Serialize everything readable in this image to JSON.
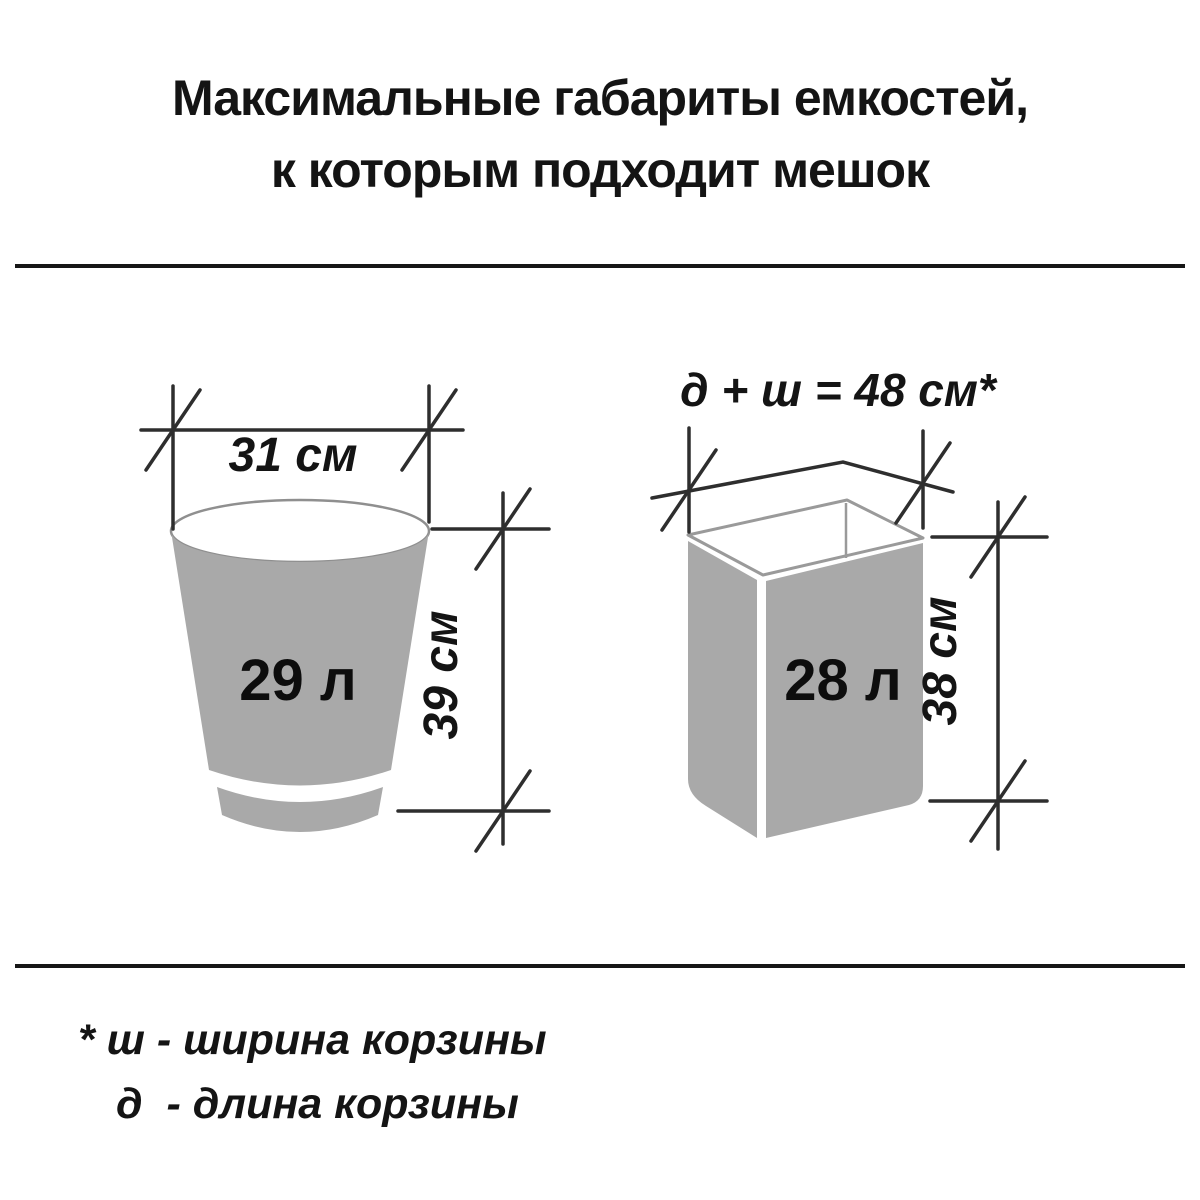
{
  "title": {
    "line1": "Максимальные габариты емкостей,",
    "line2": "к которым подходит мешок"
  },
  "figures": {
    "bucket": {
      "width_label": "31 см",
      "height_label": "39 см",
      "volume_label": "29 л"
    },
    "basket": {
      "dimension_formula": "д + ш = 48 см*",
      "height_label": "38 см",
      "volume_label": "28 л"
    }
  },
  "footnote": {
    "line1": "* ш - ширина корзины",
    "line2": "д  - длина корзины"
  },
  "colors": {
    "container_fill": "#a9a9a9",
    "rim_outline": "#8f8f8f",
    "dimension_line": "#2e2e2e",
    "text": "#141414",
    "background": "#ffffff"
  }
}
